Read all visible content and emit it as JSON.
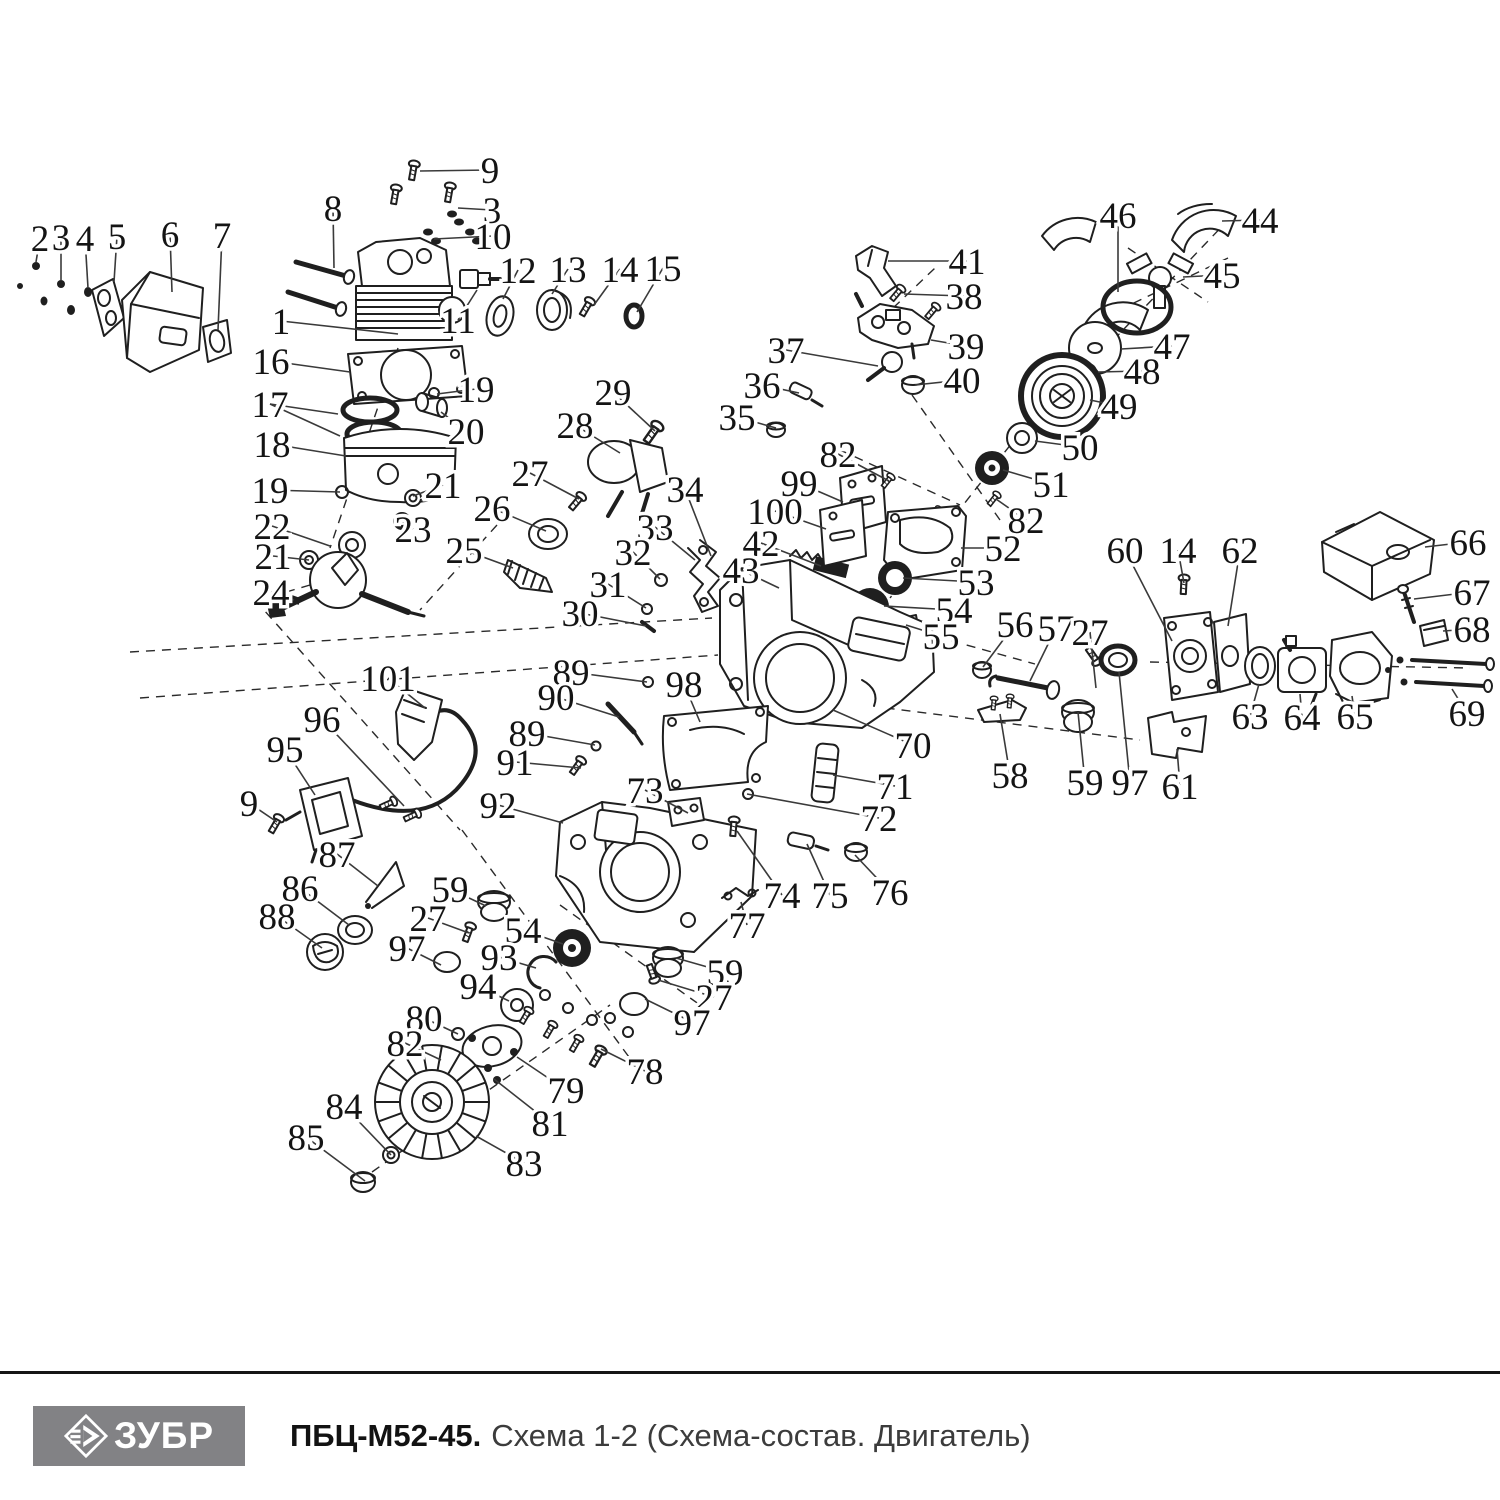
{
  "footer": {
    "brand": "ЗУБР",
    "model": "ПБЦ-М52-45.",
    "subtitle": "Схема 1-2 (Схема-состав. Двигатель)"
  },
  "colors": {
    "line": "#1f1f1f",
    "leader": "#3a3a3a",
    "label": "#141414",
    "logo_bg": "#828285",
    "logo_text": "#ffffff",
    "divider": "#161616"
  },
  "callouts": [
    {
      "n": "2",
      "x": 40,
      "y": 238,
      "tx": 36,
      "ty": 262
    },
    {
      "n": "3",
      "x": 61,
      "y": 237,
      "tx": 61,
      "ty": 280
    },
    {
      "n": "4",
      "x": 85,
      "y": 238,
      "tx": 88,
      "ty": 288
    },
    {
      "n": "5",
      "x": 117,
      "y": 236,
      "tx": 114,
      "ty": 282
    },
    {
      "n": "6",
      "x": 170,
      "y": 234,
      "tx": 172,
      "ty": 292
    },
    {
      "n": "7",
      "x": 222,
      "y": 235,
      "tx": 218,
      "ty": 330
    },
    {
      "n": "8",
      "x": 333,
      "y": 208,
      "tx": 334,
      "ty": 268
    },
    {
      "n": "9",
      "x": 490,
      "y": 170,
      "tx": 420,
      "ty": 171
    },
    {
      "n": "3",
      "x": 492,
      "y": 210,
      "tx": 458,
      "ty": 208
    },
    {
      "n": "10",
      "x": 493,
      "y": 236,
      "tx": 434,
      "ty": 239
    },
    {
      "n": "12",
      "x": 518,
      "y": 270,
      "tx": 503,
      "ty": 299
    },
    {
      "n": "13",
      "x": 568,
      "y": 269,
      "tx": 552,
      "ty": 294
    },
    {
      "n": "14",
      "x": 620,
      "y": 269,
      "tx": 594,
      "ty": 305
    },
    {
      "n": "15",
      "x": 663,
      "y": 268,
      "tx": 637,
      "ty": 312
    },
    {
      "n": "1",
      "x": 281,
      "y": 321,
      "tx": 398,
      "ty": 334
    },
    {
      "n": "11",
      "x": 458,
      "y": 320,
      "tx": 477,
      "ty": 290
    },
    {
      "n": "16",
      "x": 271,
      "y": 361,
      "tx": 350,
      "ty": 372
    },
    {
      "n": "19",
      "x": 476,
      "y": 389,
      "tx": 437,
      "ty": 394
    },
    {
      "n": "17",
      "x": 270,
      "y": 404,
      "tx": 338,
      "ty": 414,
      "tx2": 340,
      "ty2": 436
    },
    {
      "n": "20",
      "x": 466,
      "y": 431,
      "tx": 441,
      "ty": 412
    },
    {
      "n": "18",
      "x": 272,
      "y": 444,
      "tx": 346,
      "ty": 456
    },
    {
      "n": "19",
      "x": 270,
      "y": 490,
      "tx": 340,
      "ty": 492
    },
    {
      "n": "21",
      "x": 443,
      "y": 485,
      "tx": 413,
      "ty": 496
    },
    {
      "n": "22",
      "x": 272,
      "y": 526,
      "tx": 330,
      "ty": 546
    },
    {
      "n": "23",
      "x": 413,
      "y": 529,
      "tx": 402,
      "ty": 521
    },
    {
      "n": "21",
      "x": 273,
      "y": 556,
      "tx": 309,
      "ty": 560
    },
    {
      "n": "24",
      "x": 271,
      "y": 592,
      "tx": 294,
      "ty": 600
    },
    {
      "n": "29",
      "x": 613,
      "y": 392,
      "tx": 655,
      "ty": 431
    },
    {
      "n": "28",
      "x": 575,
      "y": 425,
      "tx": 620,
      "ty": 453
    },
    {
      "n": "27",
      "x": 530,
      "y": 473,
      "tx": 579,
      "ty": 499
    },
    {
      "n": "26",
      "x": 492,
      "y": 508,
      "tx": 546,
      "ty": 531
    },
    {
      "n": "25",
      "x": 464,
      "y": 550,
      "tx": 513,
      "ty": 568
    },
    {
      "n": "34",
      "x": 685,
      "y": 489,
      "tx": 711,
      "ty": 556
    },
    {
      "n": "33",
      "x": 655,
      "y": 527,
      "tx": 695,
      "ty": 560
    },
    {
      "n": "32",
      "x": 633,
      "y": 552,
      "tx": 660,
      "ty": 579
    },
    {
      "n": "31",
      "x": 608,
      "y": 584,
      "tx": 646,
      "ty": 608
    },
    {
      "n": "30",
      "x": 580,
      "y": 613,
      "tx": 646,
      "ty": 626
    },
    {
      "n": "41",
      "x": 967,
      "y": 261,
      "tx": 888,
      "ty": 261
    },
    {
      "n": "38",
      "x": 964,
      "y": 296,
      "tx": 904,
      "ty": 294
    },
    {
      "n": "39",
      "x": 966,
      "y": 346,
      "tx": 931,
      "ty": 340
    },
    {
      "n": "40",
      "x": 962,
      "y": 380,
      "tx": 915,
      "ty": 385
    },
    {
      "n": "37",
      "x": 786,
      "y": 350,
      "tx": 878,
      "ty": 366
    },
    {
      "n": "36",
      "x": 762,
      "y": 385,
      "tx": 799,
      "ty": 393
    },
    {
      "n": "35",
      "x": 737,
      "y": 417,
      "tx": 776,
      "ty": 428
    },
    {
      "n": "46",
      "x": 1118,
      "y": 215,
      "tx": 1118,
      "ty": 292
    },
    {
      "n": "44",
      "x": 1260,
      "y": 220,
      "tx": 1222,
      "ty": 221
    },
    {
      "n": "45",
      "x": 1222,
      "y": 275,
      "tx": 1183,
      "ty": 277
    },
    {
      "n": "47",
      "x": 1172,
      "y": 346,
      "tx": 1121,
      "ty": 349
    },
    {
      "n": "48",
      "x": 1142,
      "y": 371,
      "tx": 1098,
      "ty": 372
    },
    {
      "n": "49",
      "x": 1119,
      "y": 406,
      "tx": 1090,
      "ty": 400
    },
    {
      "n": "50",
      "x": 1080,
      "y": 447,
      "tx": 1035,
      "ty": 441
    },
    {
      "n": "51",
      "x": 1051,
      "y": 484,
      "tx": 1003,
      "ty": 470
    },
    {
      "n": "82",
      "x": 838,
      "y": 454,
      "tx": 889,
      "ty": 481
    },
    {
      "n": "99",
      "x": 799,
      "y": 483,
      "tx": 843,
      "ty": 502
    },
    {
      "n": "100",
      "x": 775,
      "y": 511,
      "tx": 826,
      "ty": 529
    },
    {
      "n": "42",
      "x": 761,
      "y": 543,
      "tx": 821,
      "ty": 566
    },
    {
      "n": "43",
      "x": 741,
      "y": 570,
      "tx": 779,
      "ty": 588
    },
    {
      "n": "82",
      "x": 1026,
      "y": 520,
      "tx": 996,
      "ty": 499
    },
    {
      "n": "52",
      "x": 1003,
      "y": 548,
      "tx": 961,
      "ty": 548
    },
    {
      "n": "53",
      "x": 976,
      "y": 582,
      "tx": 903,
      "ty": 578
    },
    {
      "n": "54",
      "x": 954,
      "y": 610,
      "tx": 884,
      "ty": 606
    },
    {
      "n": "55",
      "x": 941,
      "y": 636,
      "tx": 906,
      "ty": 625
    },
    {
      "n": "56",
      "x": 1015,
      "y": 624,
      "tx": 983,
      "ty": 667
    },
    {
      "n": "57",
      "x": 1056,
      "y": 628,
      "tx": 1030,
      "ty": 681
    },
    {
      "n": "27",
      "x": 1090,
      "y": 632,
      "tx": 1096,
      "ty": 688
    },
    {
      "n": "60",
      "x": 1125,
      "y": 550,
      "tx": 1172,
      "ty": 641
    },
    {
      "n": "14",
      "x": 1178,
      "y": 550,
      "tx": 1184,
      "ty": 583
    },
    {
      "n": "62",
      "x": 1240,
      "y": 550,
      "tx": 1228,
      "ty": 626
    },
    {
      "n": "66",
      "x": 1468,
      "y": 542,
      "tx": 1425,
      "ty": 547
    },
    {
      "n": "67",
      "x": 1472,
      "y": 592,
      "tx": 1414,
      "ty": 599
    },
    {
      "n": "68",
      "x": 1472,
      "y": 629,
      "tx": 1443,
      "ty": 631
    },
    {
      "n": "69",
      "x": 1467,
      "y": 713,
      "tx": 1452,
      "ty": 689
    },
    {
      "n": "63",
      "x": 1250,
      "y": 716,
      "tx": 1259,
      "ty": 684
    },
    {
      "n": "64",
      "x": 1302,
      "y": 717,
      "tx": 1300,
      "ty": 694
    },
    {
      "n": "65",
      "x": 1355,
      "y": 716,
      "tx": 1352,
      "ty": 696
    },
    {
      "n": "58",
      "x": 1010,
      "y": 775,
      "tx": 1000,
      "ty": 714
    },
    {
      "n": "59",
      "x": 1085,
      "y": 782,
      "tx": 1078,
      "ty": 712
    },
    {
      "n": "97",
      "x": 1130,
      "y": 782,
      "tx": 1119,
      "ty": 672
    },
    {
      "n": "61",
      "x": 1180,
      "y": 786,
      "tx": 1177,
      "ty": 749
    },
    {
      "n": "70",
      "x": 913,
      "y": 745,
      "tx": 833,
      "ty": 710
    },
    {
      "n": "71",
      "x": 895,
      "y": 786,
      "tx": 833,
      "ty": 775
    },
    {
      "n": "72",
      "x": 879,
      "y": 818,
      "tx": 747,
      "ty": 794
    },
    {
      "n": "89",
      "x": 571,
      "y": 672,
      "tx": 647,
      "ty": 682
    },
    {
      "n": "90",
      "x": 556,
      "y": 697,
      "tx": 619,
      "ty": 717
    },
    {
      "n": "98",
      "x": 684,
      "y": 684,
      "tx": 700,
      "ty": 722
    },
    {
      "n": "89",
      "x": 527,
      "y": 733,
      "tx": 595,
      "ty": 745
    },
    {
      "n": "91",
      "x": 515,
      "y": 762,
      "tx": 581,
      "ty": 768
    },
    {
      "n": "101",
      "x": 388,
      "y": 678,
      "tx": 425,
      "ty": 708
    },
    {
      "n": "96",
      "x": 322,
      "y": 719,
      "tx": 404,
      "ty": 806
    },
    {
      "n": "95",
      "x": 285,
      "y": 749,
      "tx": 315,
      "ty": 795
    },
    {
      "n": "9",
      "x": 249,
      "y": 803,
      "tx": 277,
      "ty": 822
    },
    {
      "n": "73",
      "x": 645,
      "y": 790,
      "tx": 688,
      "ty": 813
    },
    {
      "n": "87",
      "x": 337,
      "y": 854,
      "tx": 378,
      "ty": 886
    },
    {
      "n": "86",
      "x": 300,
      "y": 888,
      "tx": 349,
      "ty": 925
    },
    {
      "n": "88",
      "x": 277,
      "y": 916,
      "tx": 322,
      "ty": 948
    },
    {
      "n": "92",
      "x": 498,
      "y": 805,
      "tx": 563,
      "ty": 823
    },
    {
      "n": "74",
      "x": 782,
      "y": 895,
      "tx": 737,
      "ty": 831
    },
    {
      "n": "75",
      "x": 830,
      "y": 895,
      "tx": 807,
      "ty": 844
    },
    {
      "n": "76",
      "x": 890,
      "y": 892,
      "tx": 855,
      "ty": 855
    },
    {
      "n": "77",
      "x": 747,
      "y": 925,
      "tx": 741,
      "ty": 902
    },
    {
      "n": "59",
      "x": 450,
      "y": 889,
      "tx": 486,
      "ty": 906
    },
    {
      "n": "27",
      "x": 428,
      "y": 918,
      "tx": 469,
      "ty": 933
    },
    {
      "n": "54",
      "x": 523,
      "y": 930,
      "tx": 563,
      "ty": 944
    },
    {
      "n": "97",
      "x": 407,
      "y": 948,
      "tx": 441,
      "ty": 965
    },
    {
      "n": "93",
      "x": 499,
      "y": 957,
      "tx": 536,
      "ty": 968
    },
    {
      "n": "94",
      "x": 478,
      "y": 986,
      "tx": 509,
      "ty": 1001
    },
    {
      "n": "59",
      "x": 725,
      "y": 972,
      "tx": 676,
      "ty": 958
    },
    {
      "n": "27",
      "x": 714,
      "y": 997,
      "tx": 658,
      "ty": 980
    },
    {
      "n": "97",
      "x": 692,
      "y": 1022,
      "tx": 645,
      "ty": 999
    },
    {
      "n": "80",
      "x": 424,
      "y": 1018,
      "tx": 458,
      "ty": 1034
    },
    {
      "n": "82",
      "x": 405,
      "y": 1043,
      "tx": 441,
      "ty": 1060
    },
    {
      "n": "79",
      "x": 566,
      "y": 1090,
      "tx": 517,
      "ty": 1057
    },
    {
      "n": "81",
      "x": 550,
      "y": 1123,
      "tx": 494,
      "ty": 1079
    },
    {
      "n": "78",
      "x": 645,
      "y": 1071,
      "tx": 601,
      "ty": 1049
    },
    {
      "n": "84",
      "x": 344,
      "y": 1106,
      "tx": 391,
      "ty": 1155
    },
    {
      "n": "85",
      "x": 306,
      "y": 1137,
      "tx": 365,
      "ty": 1181
    },
    {
      "n": "83",
      "x": 524,
      "y": 1163,
      "tx": 476,
      "ty": 1136
    }
  ]
}
